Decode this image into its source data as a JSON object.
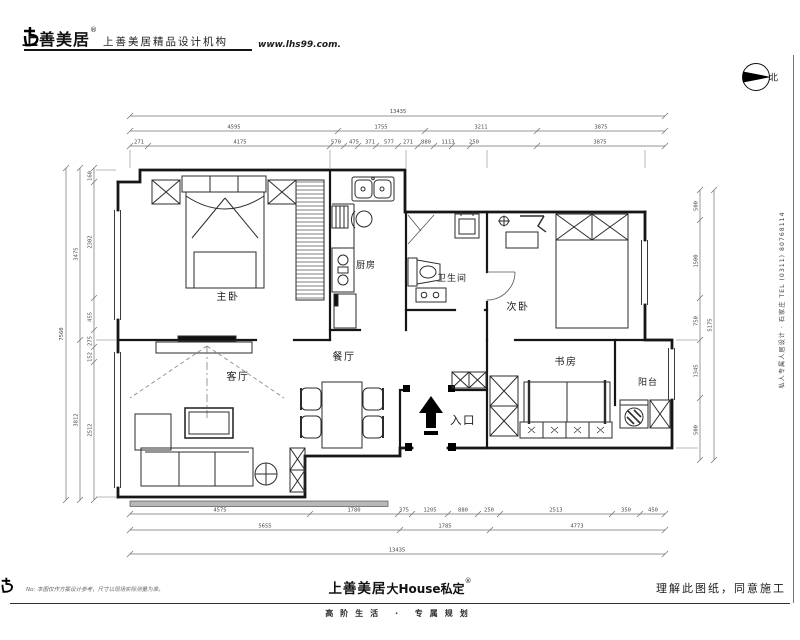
{
  "header": {
    "brand": "上善美居",
    "reg": "®",
    "agency": "上善美居精品设计机构",
    "url": "www.lhs99.com."
  },
  "compass": {
    "label": "北"
  },
  "rooms": {
    "master": "主卧",
    "kitchen": "厨房",
    "bath": "卫生间",
    "second": "次卧",
    "living": "客厅",
    "dining": "餐厅",
    "study": "书房",
    "balcony": "阳台",
    "entry": "入口"
  },
  "dims": {
    "top_total": "13435",
    "top_row2": [
      "4595",
      "1755",
      "3211",
      "3875"
    ],
    "top_row3": [
      "271",
      "4175",
      "570",
      "475",
      "371",
      "577",
      "271",
      "880",
      "1113",
      "250",
      "3875"
    ],
    "left_total": "7560",
    "left_mid": [
      "3475",
      "3812"
    ],
    "left_inner": [
      "160",
      "2302",
      "455",
      "275",
      "152",
      "2512"
    ],
    "right_inner": [
      "500",
      "1500",
      "750",
      "1345",
      "500"
    ],
    "right_total": "5175",
    "bottom_row1": [
      "4575",
      "1780",
      "375",
      "1205",
      "880",
      "250",
      "2513",
      "350",
      "450"
    ],
    "bottom_row2": [
      "5655",
      "1785",
      "4773"
    ],
    "bottom_total": "13435"
  },
  "footer": {
    "brand": "上善美居",
    "suffix": "大House私定",
    "reg": "®",
    "tagline": "高阶生活 · 专属规划",
    "approval": "理解此图纸，同意施工",
    "note": "No: 本图仅作方案设计参考，尺寸以现场实际测量为准。"
  },
  "side_text": "私人专属人居设计 · 石家庄  TEL (0311) 80768114",
  "colors": {
    "line": "#161616",
    "dim_line": "#707070",
    "accent": "#000000"
  }
}
